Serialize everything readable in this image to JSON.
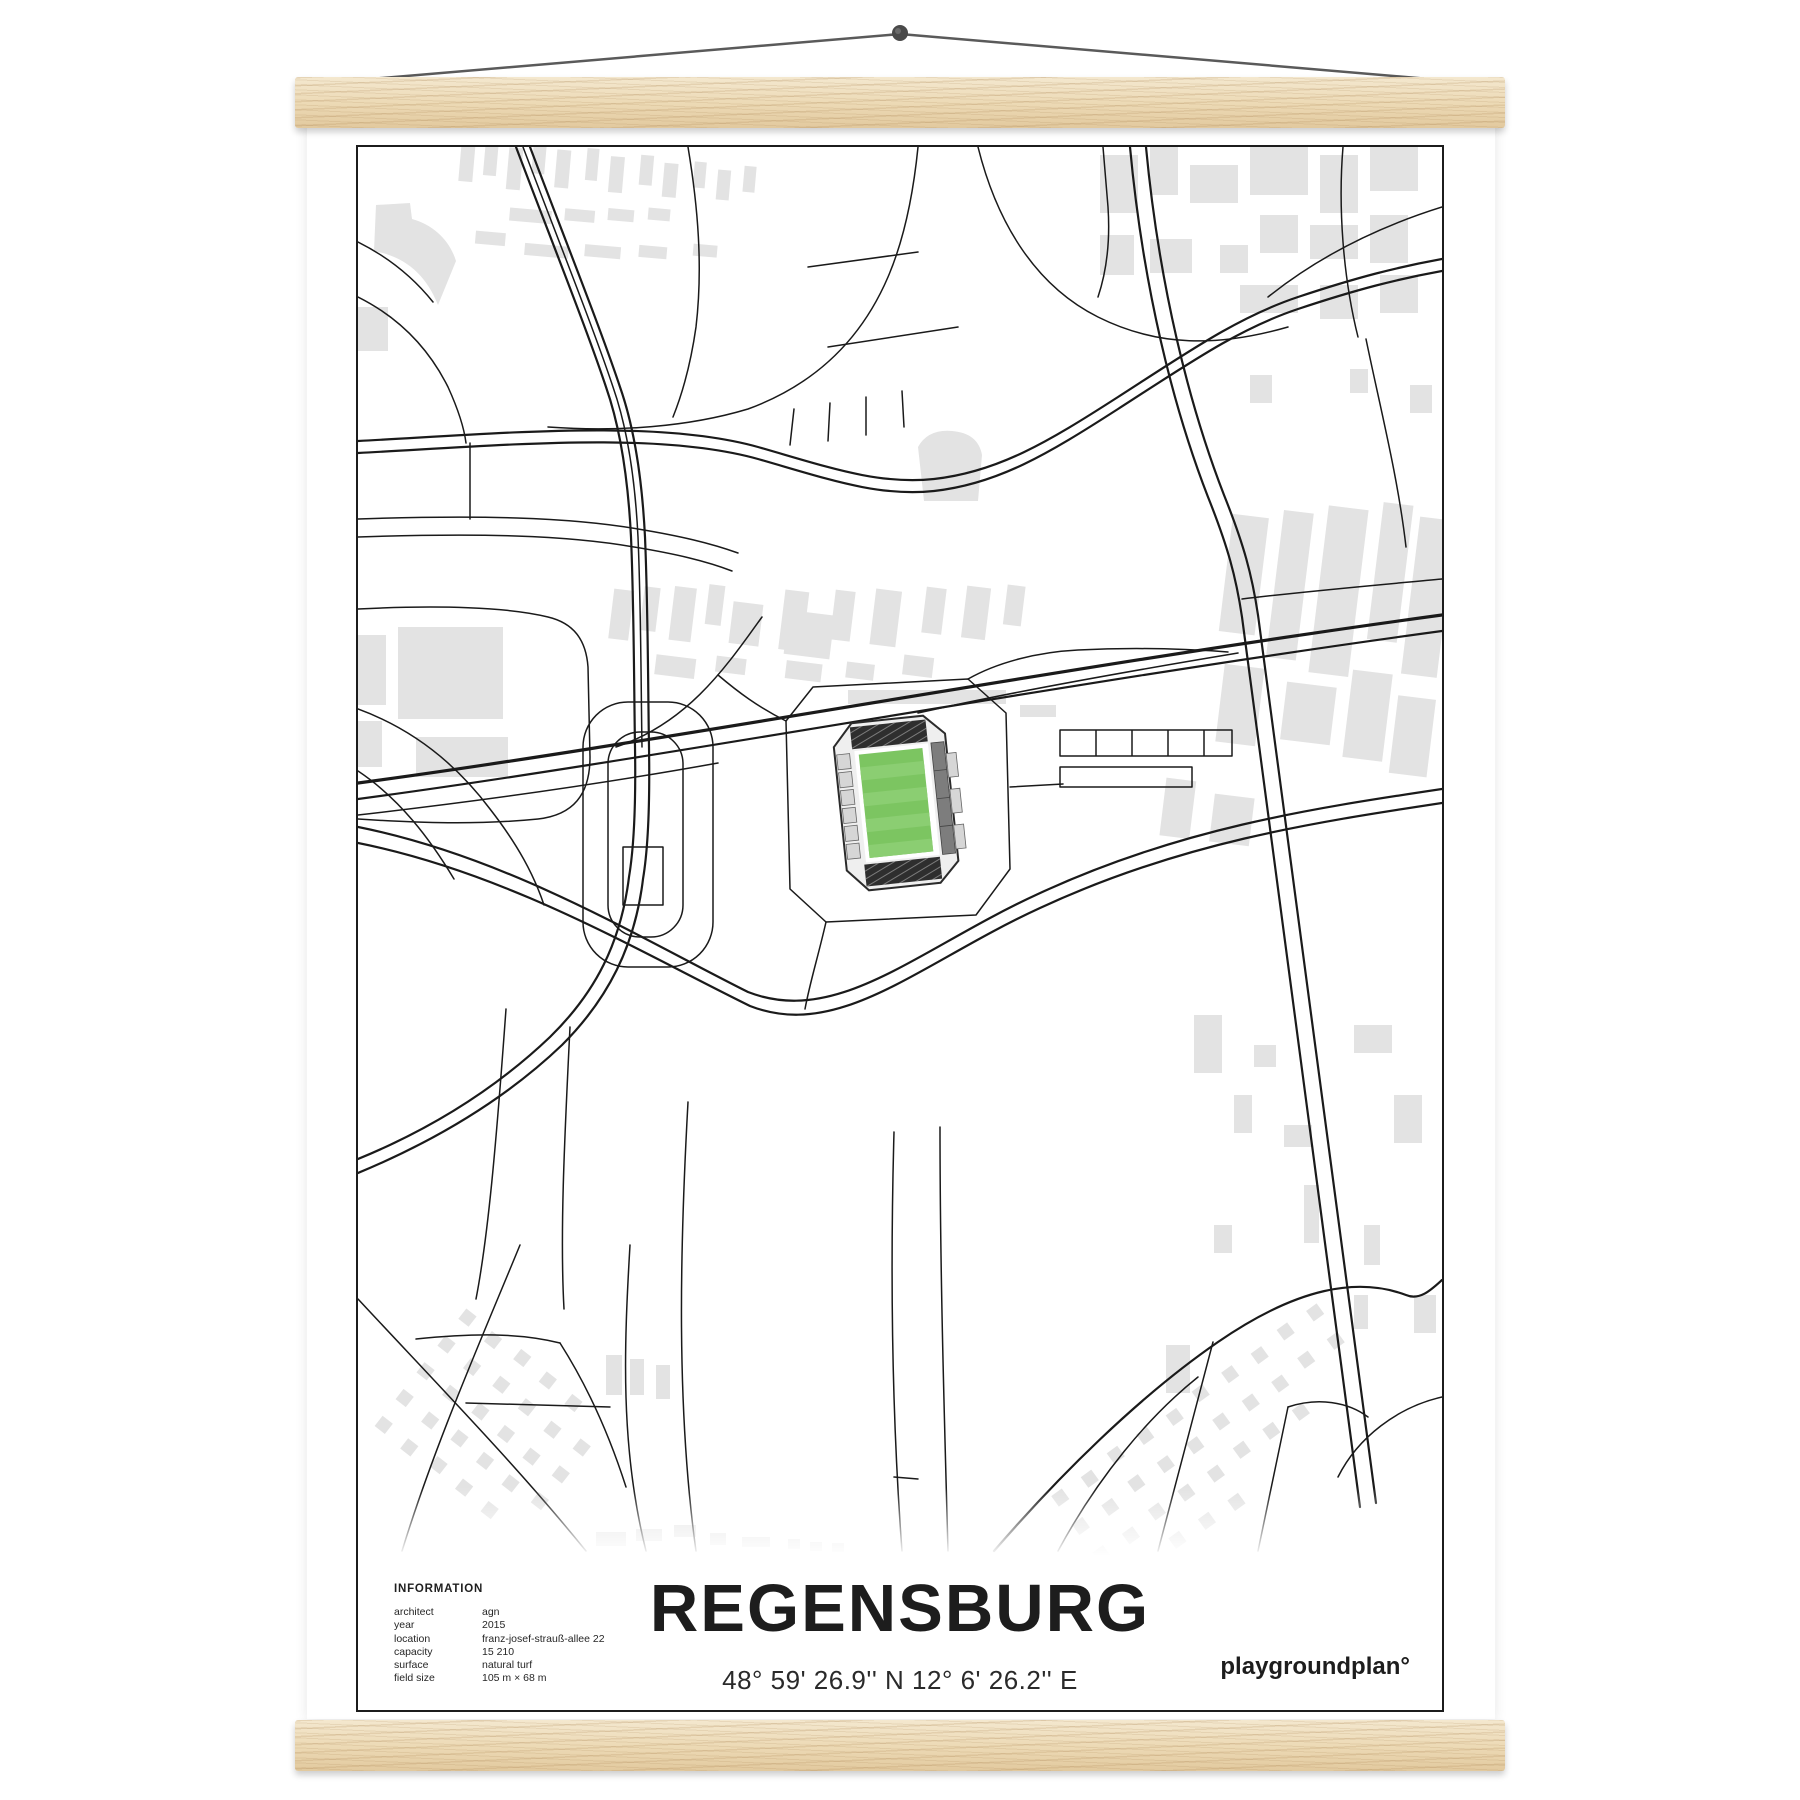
{
  "theme": {
    "paper": "#ffffff",
    "frame_border": "#1c1c1c",
    "road_color": "#1a1a1a",
    "building_color": "#e3e3e3",
    "pitch_green": "#7cc561",
    "pitch_stripe": "#8bce72",
    "stand_dark": "#2e2e2e",
    "stand_gray": "#d6d6d6",
    "wood_light": "#f4e8cf",
    "wood_mid": "#ecd9b4",
    "wood_dark": "#e2c99e",
    "string_color": "#5a5a5a"
  },
  "poster": {
    "title": "REGENSBURG",
    "coordinates": "48° 59' 26.9'' N  12° 6' 26.2'' E",
    "brand": "playgroundplan°",
    "info": {
      "heading": "INFORMATION",
      "rows": [
        {
          "label": "architect",
          "value": "agn"
        },
        {
          "label": "year",
          "value": "2015"
        },
        {
          "label": "location",
          "value": "franz-josef-strauß-allee 22"
        },
        {
          "label": "capacity",
          "value": "15 210"
        },
        {
          "label": "surface",
          "value": "natural turf"
        },
        {
          "label": "field size",
          "value": "105 m × 68 m"
        }
      ]
    }
  }
}
